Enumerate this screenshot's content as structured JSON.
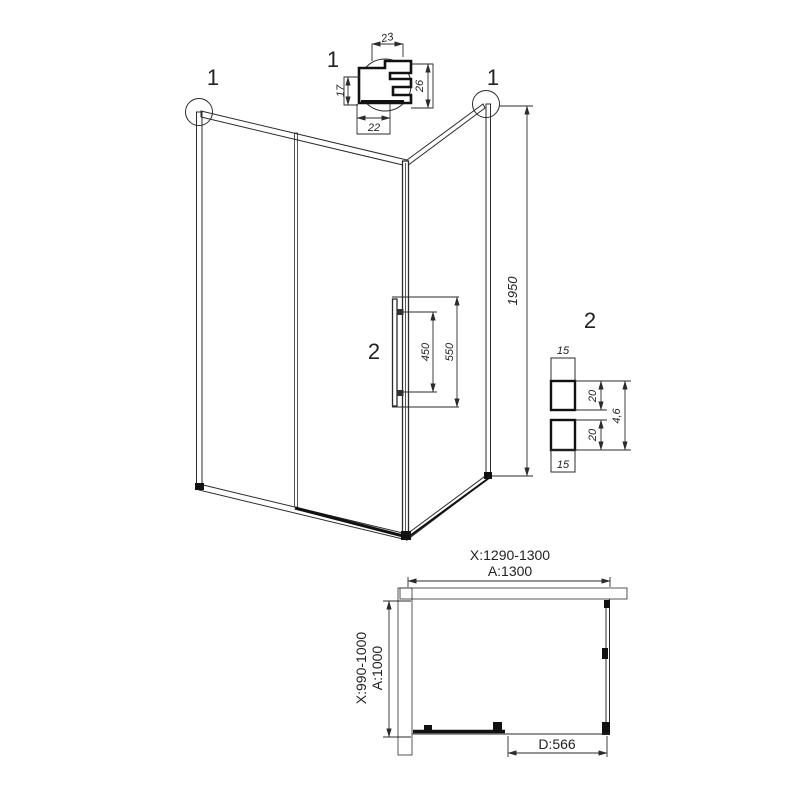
{
  "colors": {
    "background": "#ffffff",
    "lines": "#2b2b2b",
    "dark": "#111111"
  },
  "corner_profile_detail": {
    "label": "1",
    "dim_top": "23",
    "dim_left": "17",
    "dim_bottom": "22",
    "dim_right": "26"
  },
  "elevation": {
    "left_corner_callout": "1",
    "right_corner_callout": "1",
    "height": "1950",
    "handle_callout": "2",
    "handle_hole_spacing": "450",
    "handle_length": "550"
  },
  "handle_profile_detail": {
    "label": "2",
    "top_width": "15",
    "upper_depth": "20",
    "overall_depth": "4,6",
    "lower_depth": "20",
    "bottom_width": "15"
  },
  "plan": {
    "width_range": "X:1290-1300",
    "width": "A:1300",
    "depth_range": "X:990-1000",
    "depth": "A:1000",
    "door_width": "D:566"
  }
}
